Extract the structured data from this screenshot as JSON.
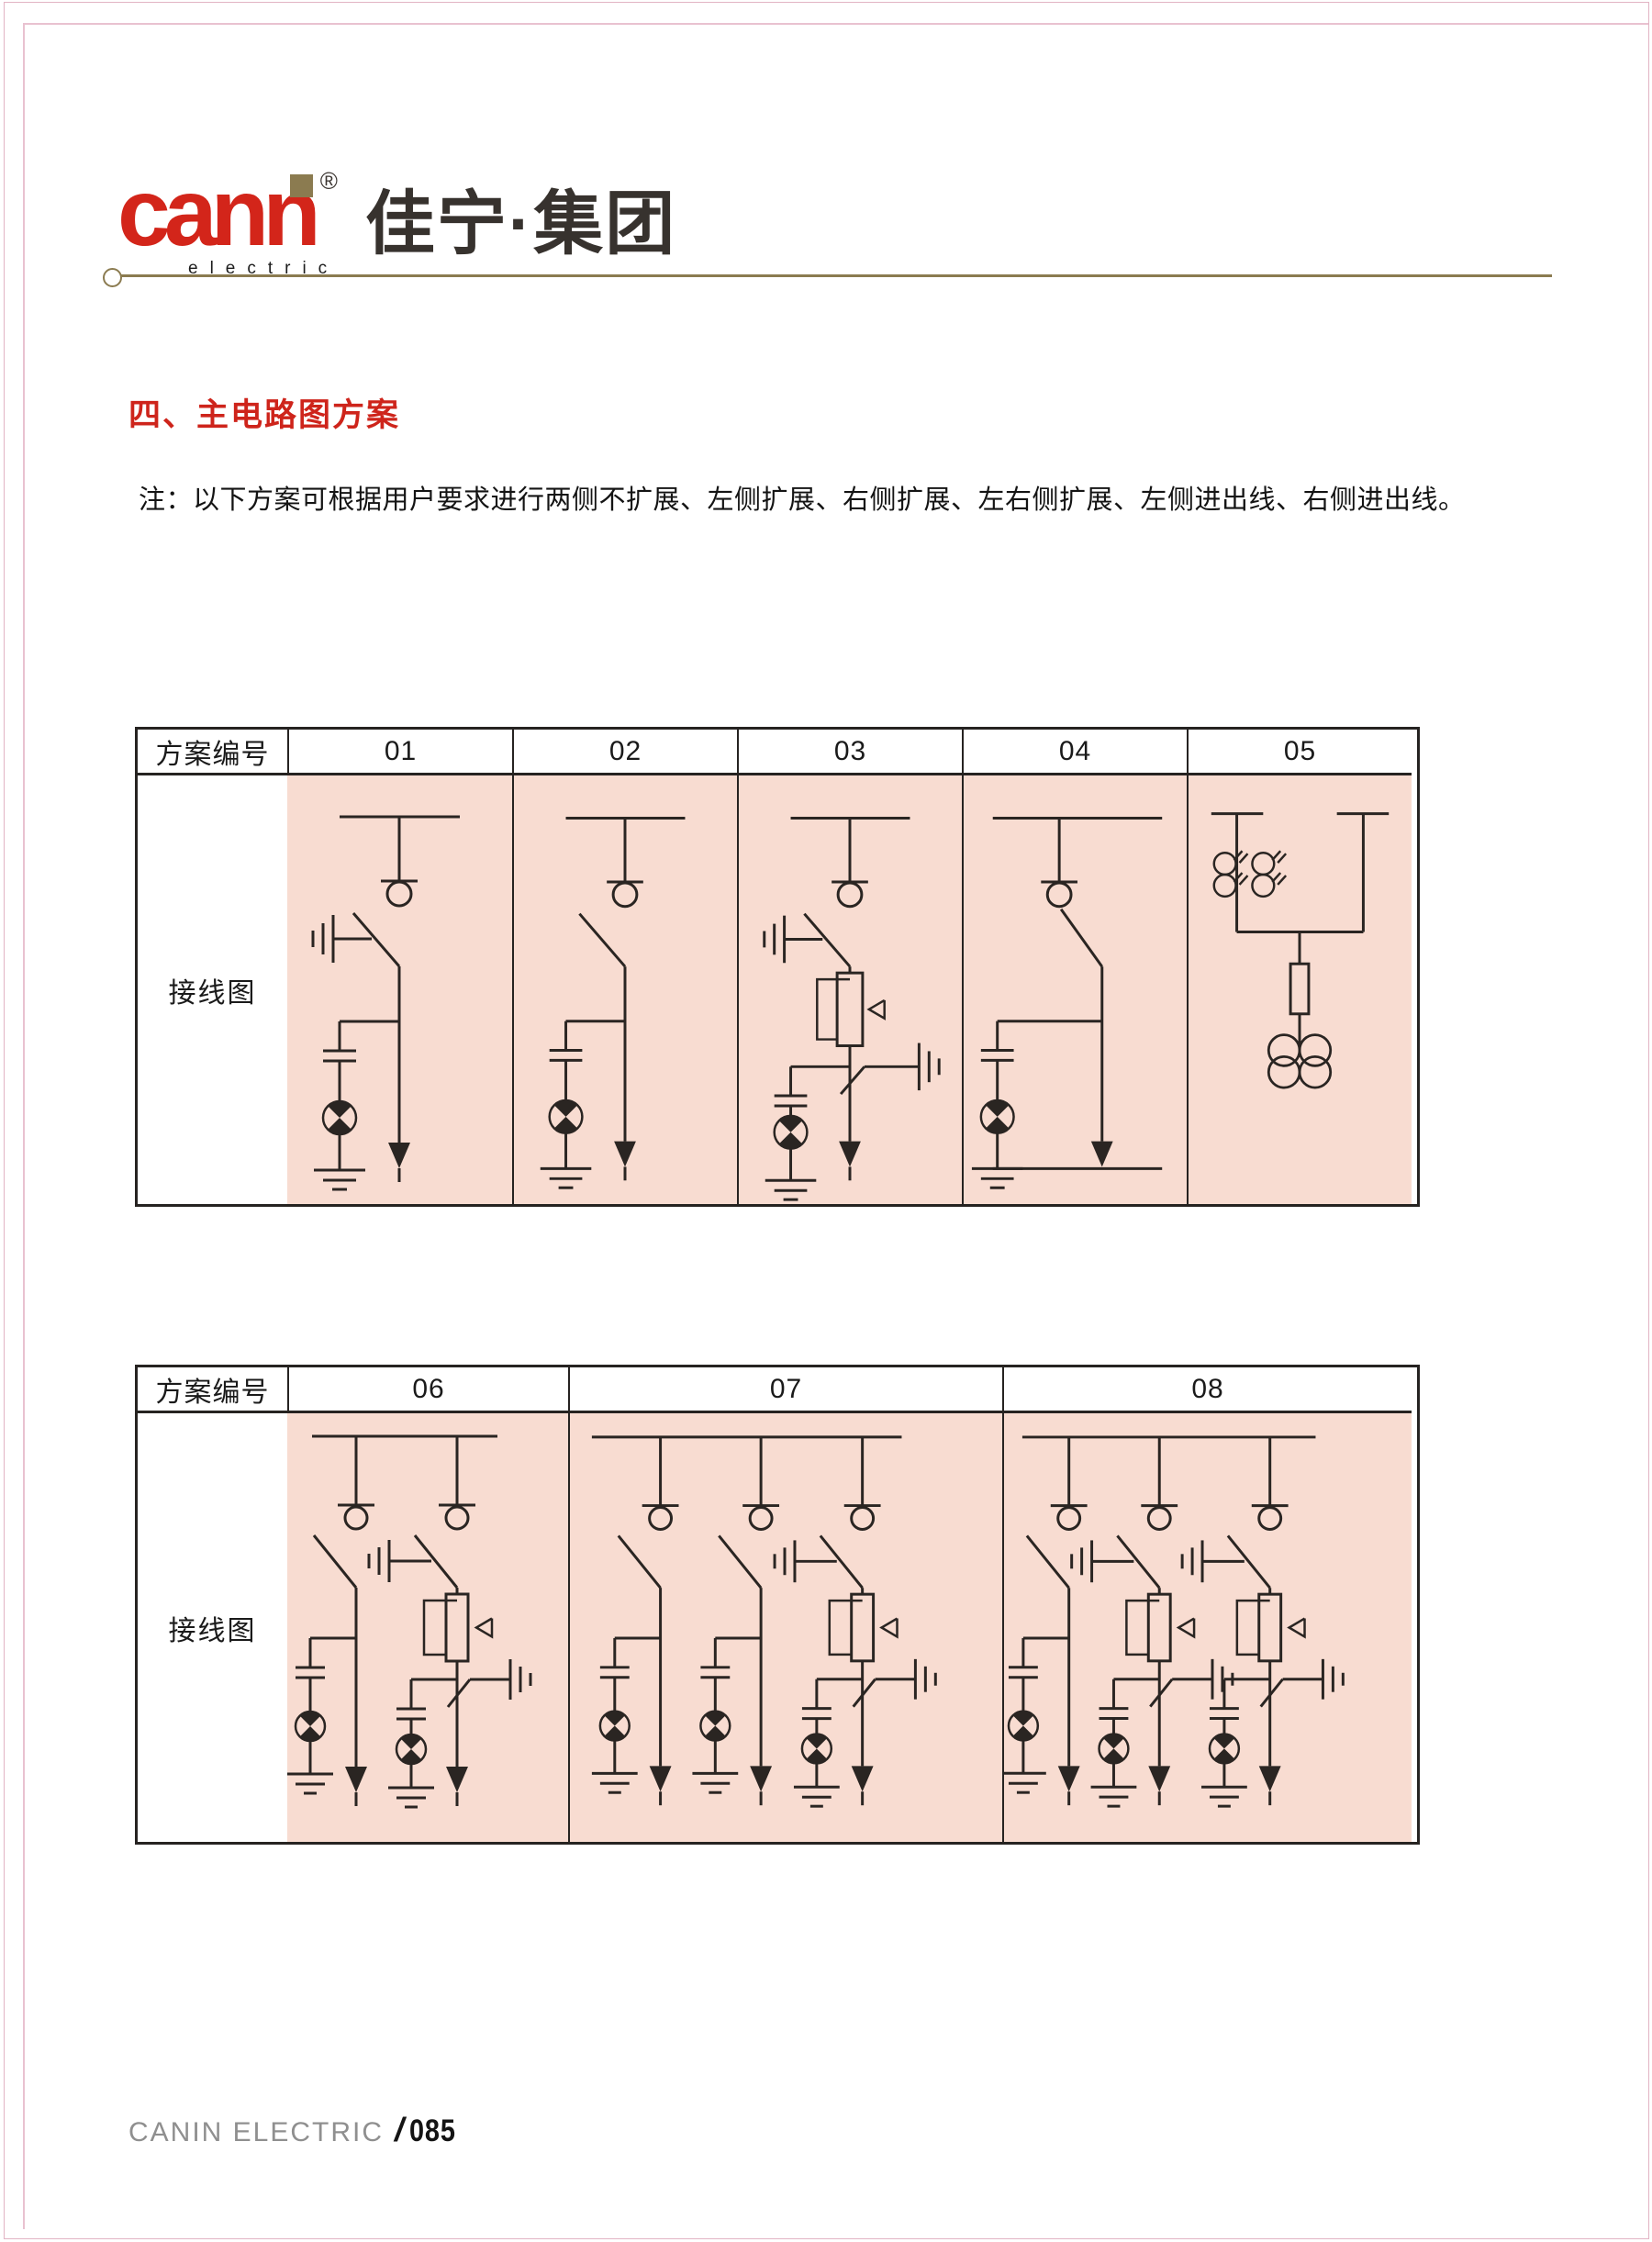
{
  "header": {
    "logo_text": "cann",
    "logo_sub": "electric",
    "reg_mark": "®",
    "brand": "佳宁·集团"
  },
  "section": {
    "title": "四、主电路图方案"
  },
  "note": "注：以下方案可根据用户要求进行两侧不扩展、左侧扩展、右侧扩展、左右侧扩展、左侧进出线、右侧进出线。",
  "tables": [
    {
      "header_label": "方案编号",
      "row_label": "接线图",
      "columns": [
        "01",
        "02",
        "03",
        "04",
        "05"
      ]
    },
    {
      "header_label": "方案编号",
      "row_label": "接线图",
      "columns": [
        "06",
        "07",
        "08"
      ]
    }
  ],
  "diagrams": {
    "01": {
      "feeders": [
        {
          "kind": "load-switch",
          "earth_switch": true
        }
      ]
    },
    "02": {
      "feeders": [
        {
          "kind": "load-switch",
          "earth_switch": false
        }
      ]
    },
    "03": {
      "feeders": [
        {
          "kind": "fuse-combination",
          "earth_switch": true
        }
      ]
    },
    "04": {
      "kind": "incoming-outgoing-switch"
    },
    "05": {
      "kind": "pt-metering"
    },
    "06": {
      "feeders": [
        {
          "kind": "load-switch",
          "earth_switch": false
        },
        {
          "kind": "fuse-combination",
          "earth_switch": true
        }
      ]
    },
    "07": {
      "feeders": [
        {
          "kind": "load-switch",
          "earth_switch": false
        },
        {
          "kind": "load-switch",
          "earth_switch": false
        },
        {
          "kind": "fuse-combination",
          "earth_switch": true
        }
      ]
    },
    "08": {
      "feeders": [
        {
          "kind": "load-switch",
          "earth_switch": false
        },
        {
          "kind": "fuse-combination",
          "earth_switch": true
        },
        {
          "kind": "fuse-combination",
          "earth_switch": true
        }
      ]
    }
  },
  "footer": {
    "company": "CANIN ELECTRIC",
    "separator": "/",
    "page_number": "085"
  },
  "colors": {
    "accent_red": "#d3251a",
    "gold": "#8b7b50",
    "pink_cell": "#f8dcd1",
    "table_ink": "#262321",
    "diagram_ink": "#2a2522",
    "frame_pink": "#e2b4c4",
    "footer_gray": "#8f8f8f"
  }
}
